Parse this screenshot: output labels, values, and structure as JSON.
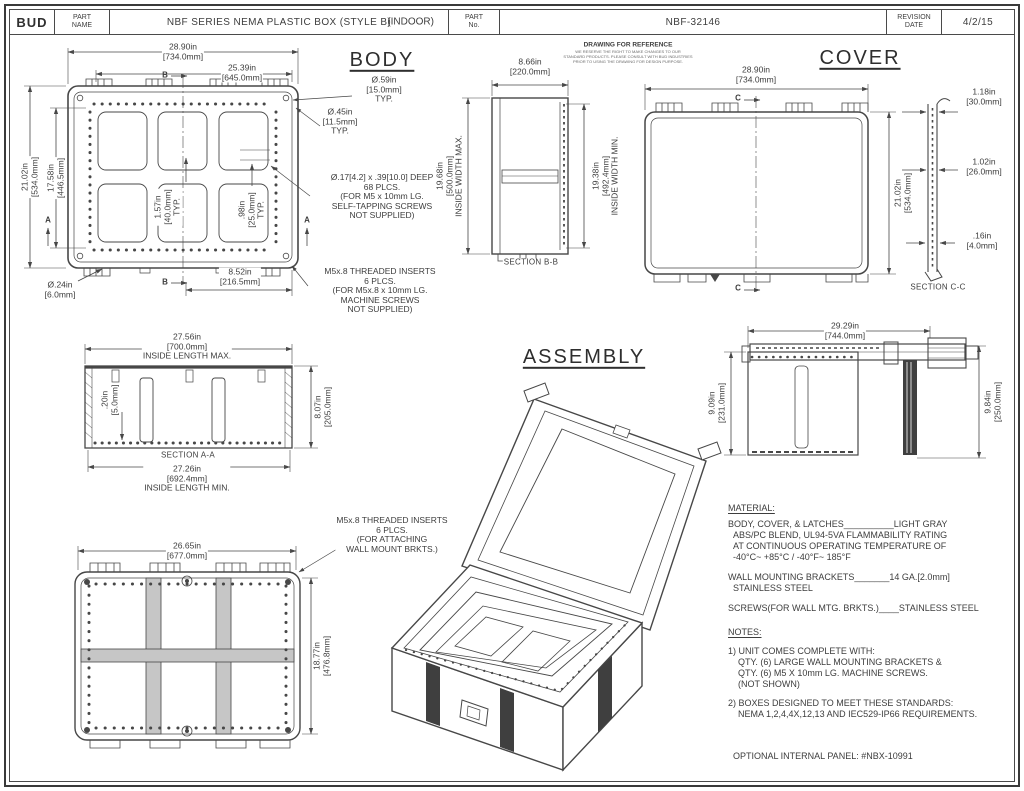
{
  "title_block": {
    "logo": "BUD",
    "part_name_label": "PART\nNAME",
    "part_name": "NBF SERIES NEMA PLASTIC BOX (STYLE B)",
    "indoor_label": "(INDOOR)",
    "part_no_label": "PART\nNo.",
    "part_no": "NBF-32146",
    "revision_label": "REVISION\nDATE",
    "revision_date": "4/2/15"
  },
  "disclaimer": {
    "title": "DRAWING FOR REFERENCE",
    "body": "WE RESERVE THE RIGHT TO MAKE CHANGES TO OUR\nSTANDARD PRODUCTS. PLEASE CONSULT WITH BUD INDUSTRIES\nPRIOR TO USING THE DRAWING FOR DESIGN PURPOSE."
  },
  "body_view": {
    "title": "BODY",
    "dim_width": "28.90in\n[734.0mm]",
    "dim_width_inner": "25.39in\n[645.0mm]",
    "dim_height": "21.02in\n[534.0mm]",
    "dim_height_inner": "17.58in\n[446.5mm]",
    "dim_pitch_40": "1.57in\n[40.0mm]\nTYP.",
    "dim_pitch_25": ".98in\n[25.0mm]\nTYP.",
    "dim_foot_hole": "Ø.24in\n[6.0mm]",
    "dim_center": "8.52in\n[216.5mm]",
    "callout_hole_59": "Ø.59in\n[15.0mm]\nTYP.",
    "callout_hole_45": "Ø.45in\n[11.5mm]\nTYP.",
    "note_screw_holes": "Ø.17[4.2] x .39[10.0] DEEP\n68 PLCS.\n(FOR M5 x 10mm LG.\nSELF-TAPPING SCREWS\nNOT SUPPLIED)",
    "note_inserts": "M5x.8 THREADED INSERTS\n6 PLCS.\n(FOR M5x.8 x 10mm LG.\nMACHINE SCREWS\nNOT SUPPLIED)",
    "marker_a": "A",
    "marker_b": "B"
  },
  "section_bb": {
    "dim_depth": "8.66in\n[220.0mm]",
    "dim_inside_max": "19.68in\n[500.0mm]\nINSIDE WIDTH MAX.",
    "dim_inside_min": "19.38in\n[492.4mm]\nINSIDE WIDTH MIN.",
    "label": "SECTION B-B"
  },
  "cover_view": {
    "title": "COVER",
    "dim_width": "28.90in\n[734.0mm]",
    "dim_height": "21.02in\n[534.0mm]",
    "marker_c": "C"
  },
  "section_cc": {
    "dim_flange": "1.18in\n[30.0mm]",
    "dim_depth": "1.02in\n[26.0mm]",
    "dim_lip": ".16in\n[4.0mm]",
    "label": "SECTION C-C"
  },
  "section_aa": {
    "dim_inside_max": "27.56in\n[700.0mm]\nINSIDE LENGTH MAX.",
    "dim_rib": ".20in\n[5.0mm]",
    "dim_depth": "8.07in\n[205.0mm]",
    "label": "SECTION A-A",
    "dim_inside_min": "27.26in\n[692.4mm]\nINSIDE LENGTH MIN."
  },
  "side_view": {
    "dim_width": "29.29in\n[744.0mm]",
    "dim_body_height": "9.09in\n[231.0mm]",
    "dim_total_height": "9.84in\n[250.0mm]"
  },
  "bottom_view": {
    "dim_width": "26.65in\n[677.0mm]",
    "dim_height": "18.77in\n[476.8mm]",
    "note_inserts": "M5x.8 THREADED INSERTS\n6 PLCS.\n(FOR ATTACHING\nWALL MOUNT BRKTS.)"
  },
  "assembly": {
    "title": "ASSEMBLY"
  },
  "material": {
    "heading": "MATERIAL:",
    "body_cover": "BODY, COVER, & LATCHES__________LIGHT GRAY\n  ABS/PC BLEND, UL94-5VA FLAMMABILITY RATING\n  AT CONTINUOUS OPERATING TEMPERATURE OF\n  -40°C~ +85°C / -40°F~ 185°F",
    "brackets": "WALL MOUNTING BRACKETS_______14 GA.[2.0mm]\n  STAINLESS STEEL",
    "screws": "SCREWS(FOR WALL MTG. BRKTS.)____STAINLESS STEEL"
  },
  "notes": {
    "heading": "NOTES:",
    "note1": "1) UNIT COMES COMPLETE WITH:\n    QTY. (6) LARGE WALL MOUNTING BRACKETS &\n    QTY. (6) M5 X 10mm LG. MACHINE SCREWS.\n    (NOT SHOWN)",
    "note2": "2) BOXES DESIGNED TO MEET THESE STANDARDS:\n    NEMA 1,2,4,4X,12,13 AND IEC529-IP66 REQUIREMENTS.",
    "optional_panel": "OPTIONAL INTERNAL PANEL: #NBX-10991"
  }
}
